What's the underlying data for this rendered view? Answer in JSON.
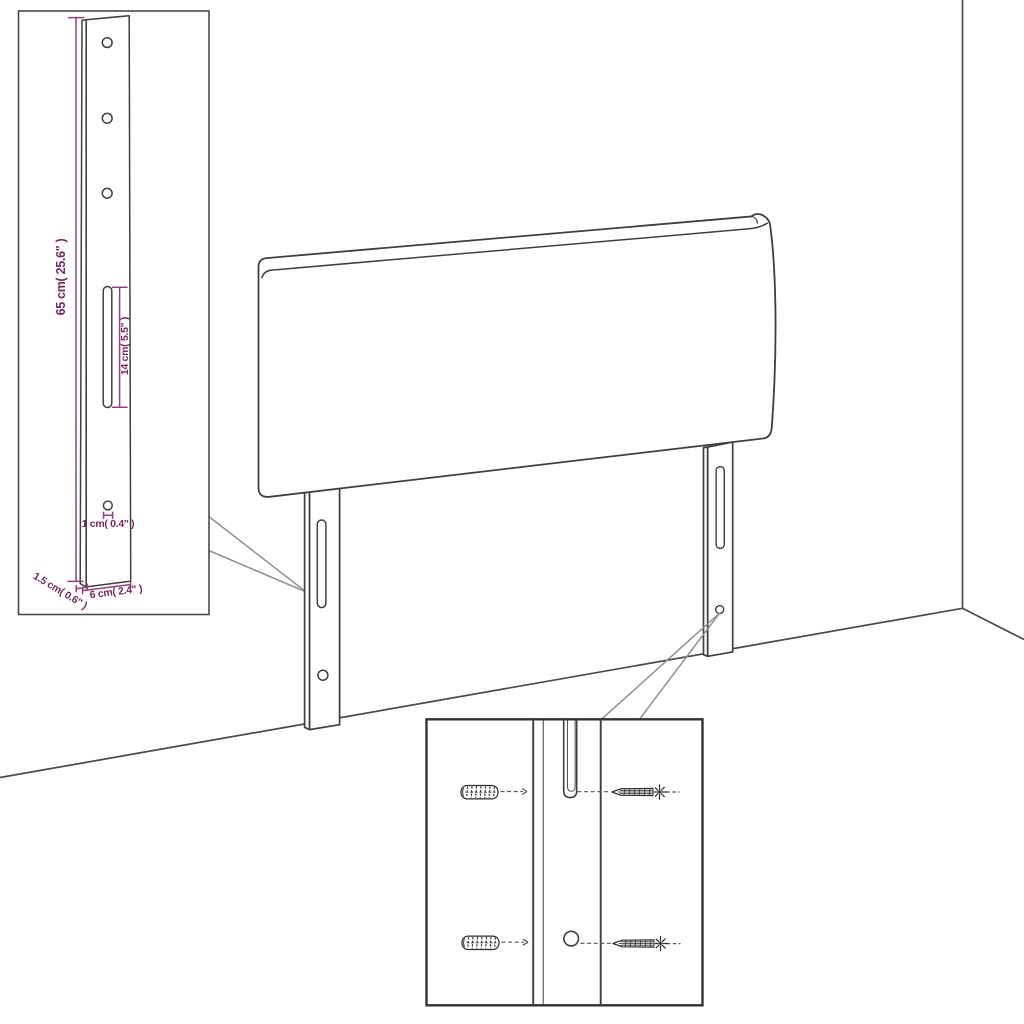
{
  "title": "Headboard with legs - dimension and mounting diagram",
  "colors": {
    "line": "#3f3f3f",
    "dimension_line": "#8e4080",
    "dimension_text": "#76295f",
    "leader_line": "#8f8f8f",
    "background": "#ffffff"
  },
  "labels": {
    "height": "65 cm( 25.6\" )",
    "slot": "14 cm( 5.5\" )",
    "hole": "1 cm( 0.4\" )",
    "thickness": "1.5 cm( 0.6\" )",
    "width": "6 cm( 2.4\" )"
  }
}
